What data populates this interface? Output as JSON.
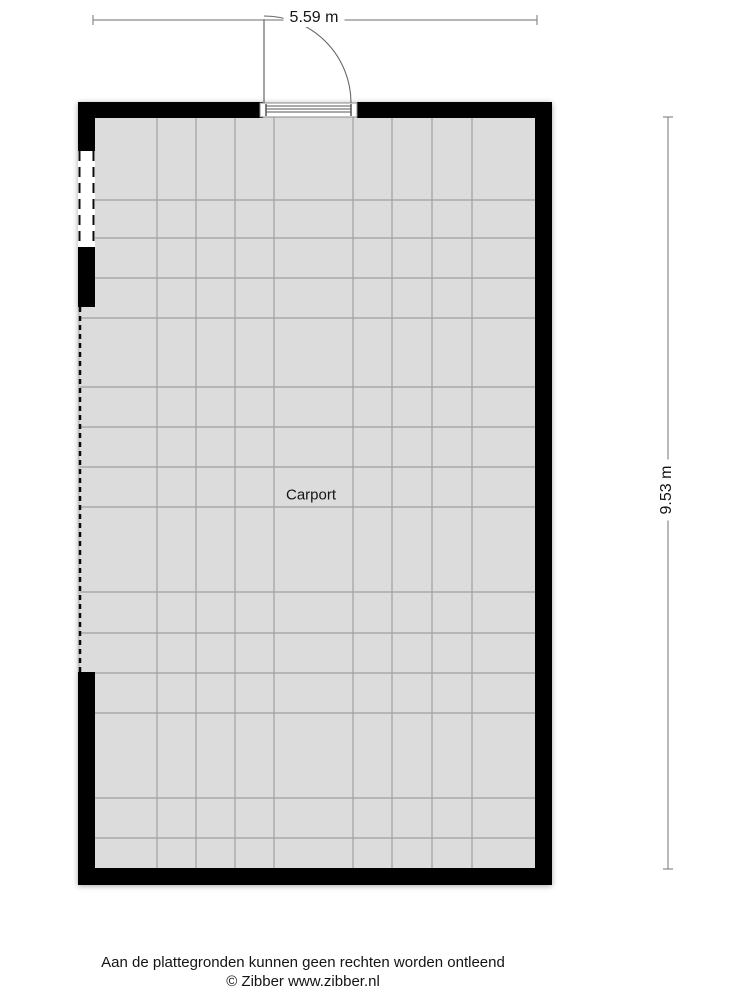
{
  "plan": {
    "room_label": "Carport",
    "dimensions": {
      "width_label": "5.59 m",
      "height_label": "9.53 m"
    }
  },
  "footer": {
    "disclaimer": "Aan de plattegronden kunnen geen rechten worden ontleend",
    "copyright": "© Zibber www.zibber.nl"
  },
  "colors": {
    "wall": "#000000",
    "floor": "#dcdcdc",
    "grid_line": "#a4a4a4",
    "dimension_line": "#8a8a8a",
    "text": "#141414",
    "background": "#ffffff"
  }
}
